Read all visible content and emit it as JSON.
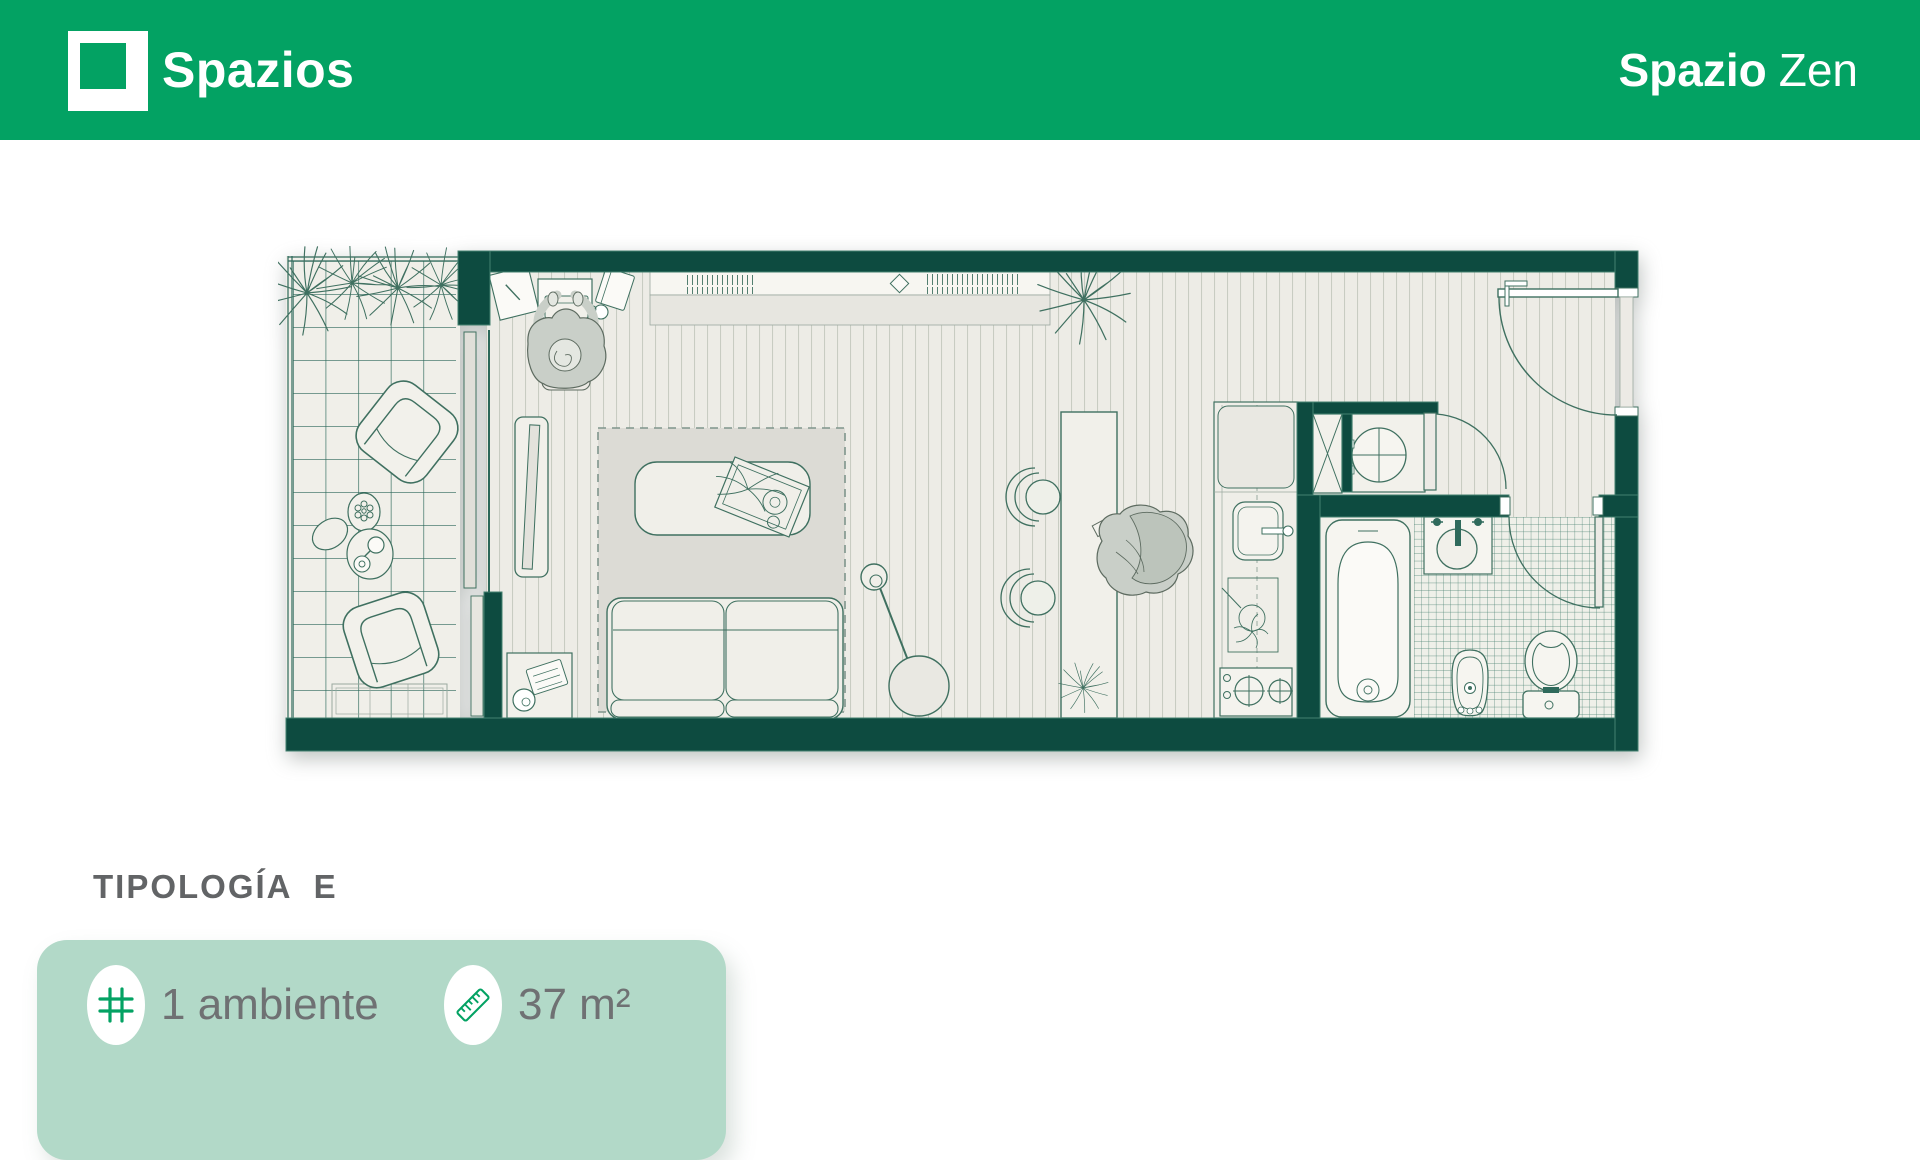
{
  "header": {
    "brand": "Spazios",
    "title_primary": "Spazio",
    "title_secondary": "Zen",
    "bg_color": "#03a263"
  },
  "typology": {
    "label": "TIPOLOGÍA  E"
  },
  "card": {
    "bg_color": "#b2d9c8",
    "features": [
      {
        "icon": "grid-icon",
        "label": "1 ambiente"
      },
      {
        "icon": "ruler-icon",
        "label": "37 m²"
      }
    ]
  },
  "floor_plan": {
    "type": "studio-apartment-top-view",
    "wall_color": "#0d4b40",
    "accent_color": "#03a263",
    "rooms": [
      "balcony",
      "living-room",
      "dining-area",
      "kitchen",
      "laundry-closet",
      "bathroom",
      "entry-hall"
    ]
  }
}
